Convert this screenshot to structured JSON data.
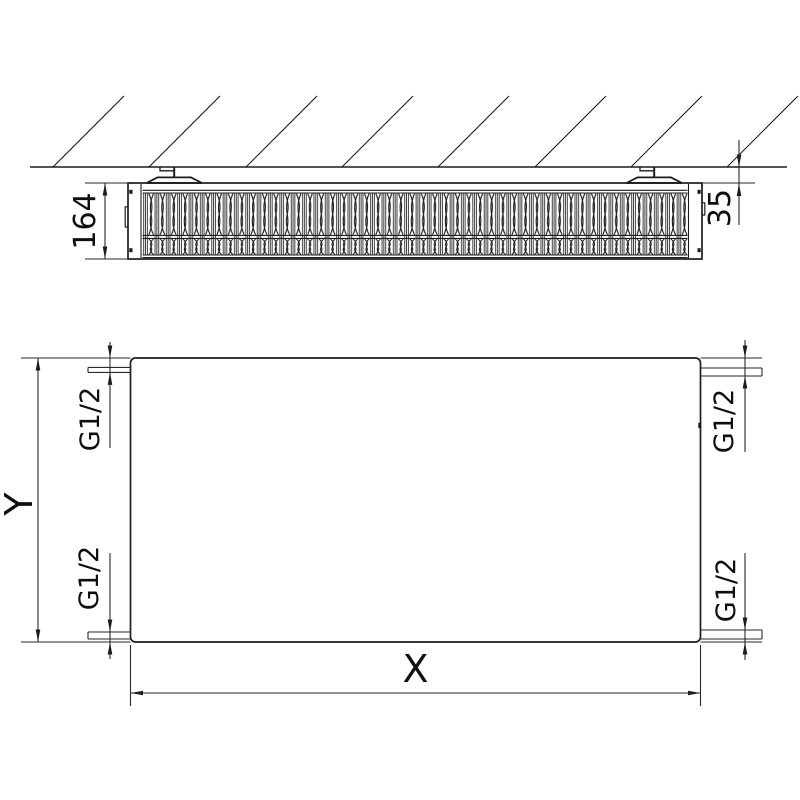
{
  "drawing": {
    "type": "radiator-technical-drawing",
    "section_top_view": {
      "depth_label": "164",
      "wall_clearance_label": "35"
    },
    "front_view": {
      "height_label": "Y",
      "width_label": "X",
      "connection_top_left": "G1/2",
      "connection_bottom_left": "G1/2",
      "connection_top_right": "G1/2",
      "connection_bottom_right": "G1/2"
    },
    "colors": {
      "line": "#1d1d1d",
      "background": "#ffffff"
    }
  }
}
